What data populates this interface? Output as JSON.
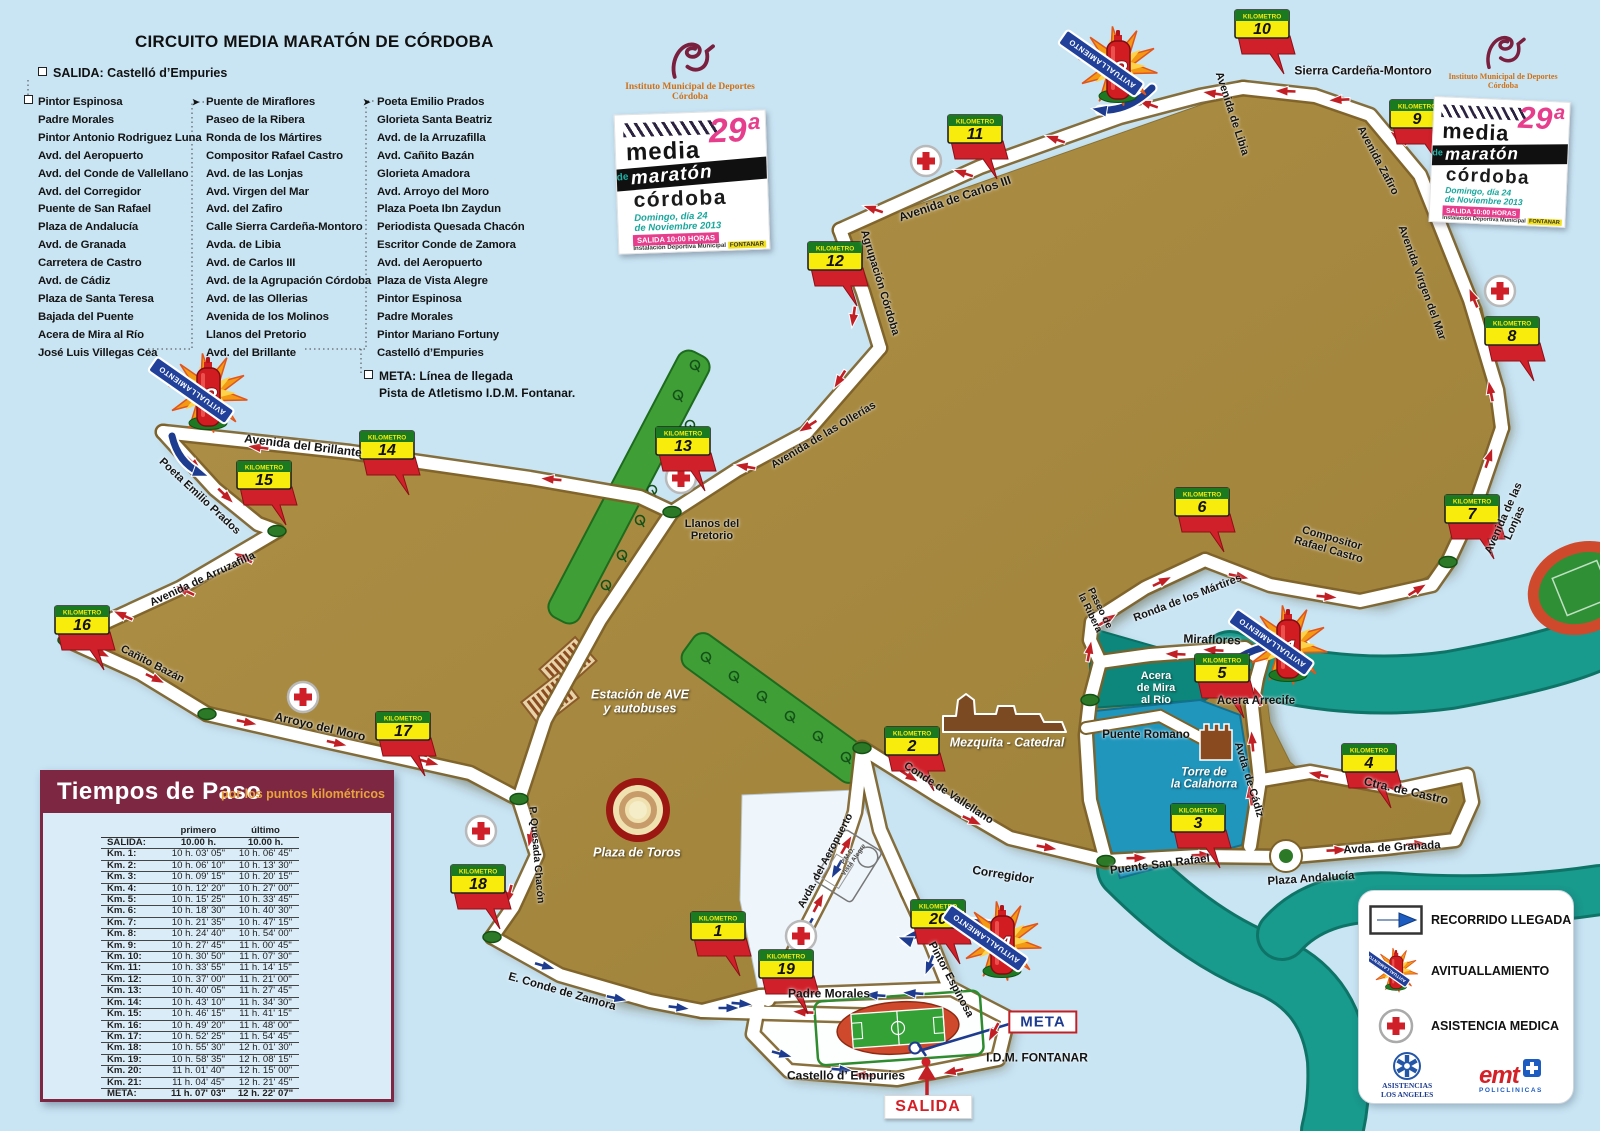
{
  "title": "CIRCUITO MEDIA MARATÓN DE CÓRDOBA",
  "salida_line": "SALIDA: Castelló d’Empuries",
  "street_columns": [
    {
      "marker": "square",
      "items": [
        "Pintor Espinosa",
        "Padre Morales",
        "Pintor Antonio Rodriguez Luna",
        "Avd. del Aeropuerto",
        "Avd. del Conde de Vallellano",
        "Avd. del Corregidor",
        "Puente de San Rafael",
        "Plaza de Andalucía",
        "Avd. de Granada",
        "Carretera de Castro",
        "Avd. de Cádiz",
        "Plaza de Santa Teresa",
        "Bajada del Puente",
        "Acera de Mira al Río",
        "José Luis Villegas Cea"
      ]
    },
    {
      "marker": "arrow",
      "items": [
        "Puente de Miraflores",
        "Paseo de la Ribera",
        "Ronda de los Mártires",
        "Compositor Rafael Castro",
        "Avd. de las Lonjas",
        "Avd. Virgen del Mar",
        "Avd. del Zafiro",
        "Calle Sierra Cardeña-Montoro",
        "Avda. de Libia",
        "Avd. de Carlos III",
        "Avd. de la Agrupación Córdoba",
        "Avd. de las Ollerias",
        "Avenida de los Molinos",
        "Llanos del Pretorio",
        "Avd. del Brillante"
      ]
    },
    {
      "marker": "arrow",
      "items": [
        "Poeta Emilio Prados",
        "Glorieta Santa Beatriz",
        "Avd. de la Arruzafilla",
        "Avd. Cañito Bazán",
        "Glorieta Amadora",
        "Avd. Arroyo del Moro",
        "Plaza Poeta Ibn Zaydun",
        "Periodista Quesada Chacón",
        "Escritor Conde de Zamora",
        "Avd. del Aeropuerto",
        "Plaza de Vista Alegre",
        "Pintor Espinosa",
        "Padre Morales",
        "Pintor Mariano Fortuny",
        "Castelló d’Empuries"
      ]
    }
  ],
  "meta_note": "META: Línea de llegada\nPista de Atletismo I.D.M. Fontanar.",
  "imd": {
    "line1": "Instituto Municipal de Deportes",
    "line2": "Córdoba"
  },
  "poster": {
    "edition": "29ª",
    "l1": "media",
    "l2": "maratón",
    "de": "de",
    "l3": "córdoba",
    "d1": "Domingo, día 24",
    "d2": "de Noviembre 2013",
    "sal": "SALIDA  10:00 HORAS",
    "ven1": "Instalación Deportiva Municipal",
    "ven2": "FONTANAR"
  },
  "map": {
    "km_label": "KILOMETRO",
    "avit_label": "AVITUALLAMIENTO",
    "kms": [
      [
        "1",
        718,
        926
      ],
      [
        "2",
        912,
        741
      ],
      [
        "3",
        1198,
        818
      ],
      [
        "4",
        1369,
        758
      ],
      [
        "5",
        1222,
        668
      ],
      [
        "6",
        1202,
        502
      ],
      [
        "7",
        1472,
        509
      ],
      [
        "8",
        1512,
        331
      ],
      [
        "9",
        1417,
        114
      ],
      [
        "10",
        1262,
        24
      ],
      [
        "11",
        975,
        129
      ],
      [
        "12",
        835,
        256
      ],
      [
        "13",
        683,
        441
      ],
      [
        "14",
        387,
        445
      ],
      [
        "15",
        264,
        475
      ],
      [
        "16",
        82,
        620
      ],
      [
        "17",
        403,
        726
      ],
      [
        "18",
        478,
        879
      ],
      [
        "19",
        786,
        964
      ],
      [
        "20",
        938,
        914
      ]
    ],
    "avits": [
      [
        "1",
        1288,
        645
      ],
      [
        "2",
        1118,
        66
      ],
      [
        "3",
        208,
        393
      ],
      [
        "4",
        1002,
        941
      ]
    ],
    "crosses": [
      [
        926,
        161
      ],
      [
        1500,
        291
      ],
      [
        681,
        478
      ],
      [
        303,
        697
      ],
      [
        481,
        831
      ],
      [
        801,
        936
      ]
    ],
    "labels": [
      [
        "Sierra Cardeña-Montoro",
        1363,
        71,
        0,
        "st",
        12
      ],
      [
        "Avenida de Libia",
        1231,
        114,
        72,
        "st",
        11
      ],
      [
        "Avenida Zafiro",
        1377,
        161,
        62,
        "st",
        11
      ],
      [
        "Avenida Virgen del Mar",
        1421,
        283,
        70,
        "st",
        11
      ],
      [
        "Avenida de Carlos III",
        955,
        199,
        -19,
        "st",
        12
      ],
      [
        "Agrupación Córdoba",
        879,
        283,
        73,
        "st",
        11
      ],
      [
        "Avenida de las Ollerías",
        824,
        436,
        -31,
        "st",
        11
      ],
      [
        "Avenida del Brillante",
        303,
        446,
        7,
        "st",
        12
      ],
      [
        "Poeta Emilio Prados",
        199,
        497,
        43,
        "st",
        11
      ],
      [
        "Avenida de Arruzafilla",
        203,
        580,
        -25,
        "st",
        11
      ],
      [
        "Cañito Bazán",
        152,
        665,
        27,
        "st",
        11
      ],
      [
        "Arroyo del Moro",
        320,
        727,
        13,
        "st",
        12
      ],
      [
        "Llanos del\nPretorio",
        712,
        531,
        0,
        "st",
        11
      ],
      [
        "Compositor\nRafael Castro",
        1330,
        545,
        16,
        "st",
        11
      ],
      [
        "Avenida de las Lonjas",
        1510,
        521,
        -66,
        "st",
        11
      ],
      [
        "Ronda de los Mártires",
        1188,
        599,
        -21,
        "st",
        11
      ],
      [
        "Paseo de\nla Ribera",
        1094,
        611,
        64,
        "st",
        10
      ],
      [
        "Miraflores",
        1212,
        640,
        2,
        "st",
        12
      ],
      [
        "Acera Arrecife",
        1256,
        701,
        0,
        "st",
        11.5
      ],
      [
        "Puente Romano",
        1146,
        735,
        0,
        "st",
        11.5
      ],
      [
        "Avda. de Cádiz",
        1248,
        780,
        73,
        "st",
        11
      ],
      [
        "Ctra. de Castro",
        1406,
        791,
        13,
        "st",
        12
      ],
      [
        "Avda. de Granada",
        1392,
        848,
        -3,
        "st",
        11.5
      ],
      [
        "Plaza Andalucía",
        1311,
        879,
        -4,
        "st",
        11.5
      ],
      [
        "Puente San Rafael",
        1160,
        865,
        -7,
        "st",
        11.5
      ],
      [
        "Corregidor",
        1003,
        875,
        9,
        "st",
        12
      ],
      [
        "Conde de Vallellano",
        948,
        794,
        33,
        "st",
        11
      ],
      [
        "P. Quesada Chacón",
        536,
        855,
        85,
        "st",
        10.5
      ],
      [
        "E. Conde de Zamora",
        562,
        992,
        16,
        "st",
        11.5
      ],
      [
        "Padre Morales",
        829,
        994,
        0,
        "st",
        12
      ],
      [
        "Pintor Espinosa",
        950,
        980,
        62,
        "st",
        11
      ],
      [
        "Avda. del Aeropuerto",
        826,
        861,
        -62,
        "st",
        10.5
      ],
      [
        "Castelló d’ Empuries",
        846,
        1076,
        0,
        "st",
        12
      ],
      [
        "I.D.M. FONTANAR",
        1037,
        1058,
        0,
        "st",
        12
      ],
      [
        "Acera\nde Mira\nal Río",
        1156,
        689,
        0,
        "wt",
        11
      ],
      [
        "Estación de AVE\ny autobuses",
        640,
        702,
        0,
        "wi",
        12.5
      ],
      [
        "Plaza de Toros",
        637,
        853,
        0,
        "wi",
        12.5
      ],
      [
        "Mezquita - Catedral",
        1007,
        743,
        0,
        "wi",
        12.5
      ],
      [
        "Torre de\nla Calahorra",
        1204,
        779,
        0,
        "wi",
        11.5
      ],
      [
        "P.M.D.\nVista Alegre",
        851,
        858,
        -55,
        "sm",
        6.5
      ]
    ],
    "signs": {
      "meta": "META",
      "salida": "SALIDA"
    }
  },
  "times": {
    "title": "Tiempos de Paso",
    "subtitle": "por los puntos kilométricos",
    "col_headers": [
      "primero",
      "último"
    ],
    "rows": [
      [
        "SALIDA:",
        "10.00 h.",
        "10.00 h.",
        1
      ],
      [
        "Km. 1:",
        "10 h. 03' 05\"",
        "10 h. 06' 45\"",
        0
      ],
      [
        "Km. 2:",
        "10 h. 06' 10\"",
        "10 h. 13' 30\"",
        0
      ],
      [
        "Km. 3:",
        "10 h. 09' 15\"",
        "10 h. 20' 15\"",
        0
      ],
      [
        "Km. 4:",
        "10 h. 12' 20\"",
        "10 h. 27' 00\"",
        0
      ],
      [
        "Km. 5:",
        "10 h. 15' 25\"",
        "10 h. 33' 45\"",
        0
      ],
      [
        "Km. 6:",
        "10 h. 18' 30\"",
        "10 h. 40' 30\"",
        0
      ],
      [
        "Km. 7:",
        "10 h. 21' 35\"",
        "10 h. 47' 15\"",
        0
      ],
      [
        "Km. 8:",
        "10 h. 24' 40\"",
        "10 h. 54' 00\"",
        0
      ],
      [
        "Km. 9:",
        "10 h. 27' 45\"",
        "11 h. 00' 45\"",
        0
      ],
      [
        "Km. 10:",
        "10 h. 30' 50\"",
        "11 h. 07' 30\"",
        0
      ],
      [
        "Km. 11:",
        "10 h. 33' 55\"",
        "11 h. 14' 15\"",
        0
      ],
      [
        "Km. 12:",
        "10 h. 37' 00\"",
        "11 h. 21' 00\"",
        0
      ],
      [
        "Km. 13:",
        "10 h. 40' 05\"",
        "11 h. 27' 45\"",
        0
      ],
      [
        "Km. 14:",
        "10 h. 43' 10\"",
        "11 h. 34' 30\"",
        0
      ],
      [
        "Km. 15:",
        "10 h. 46' 15\"",
        "11 h. 41' 15\"",
        0
      ],
      [
        "Km. 16:",
        "10 h. 49' 20\"",
        "11 h. 48' 00\"",
        0
      ],
      [
        "Km. 17:",
        "10 h. 52' 25\"",
        "11 h. 54' 45\"",
        0
      ],
      [
        "Km. 18:",
        "10 h. 55' 30\"",
        "12 h. 01' 30\"",
        0
      ],
      [
        "Km. 19:",
        "10 h. 58' 35\"",
        "12 h. 08' 15\"",
        0
      ],
      [
        "Km. 20:",
        "11 h. 01' 40\"",
        "12 h. 15' 00\"",
        0
      ],
      [
        "Km. 21:",
        "11 h. 04' 45\"",
        "12 h. 21' 45\"",
        0
      ],
      [
        "META:",
        "11 h. 07' 03\"",
        "12 h. 22' 07\"",
        1
      ]
    ]
  },
  "legend": {
    "items": [
      {
        "icon": "arrow",
        "label": "RECORRIDO LLEGADA"
      },
      {
        "icon": "bottle",
        "label": "AVITUALLAMIENTO"
      },
      {
        "icon": "cross",
        "label": "ASISTENCIA MEDICA"
      }
    ],
    "sponsor1_l1": "ASISTENCIAS",
    "sponsor1_l2": "LOS ANGELES",
    "sponsor2_name": "emt",
    "sponsor2_sub": "POLICLINICAS"
  },
  "colors": {
    "background": "#c9e5f4",
    "land": "#a5873e",
    "river": "#189a8c",
    "river_blue": "#2096bd",
    "road": "#ffffff",
    "km_yellow": "#f7ec0c",
    "km_green": "#1b7a1f",
    "flag_red": "#d0202a",
    "arrow_red": "#c21f24",
    "arrow_blue": "#1d3c8f",
    "table_maroon": "#7d2743",
    "park_green": "#3f9e35"
  }
}
